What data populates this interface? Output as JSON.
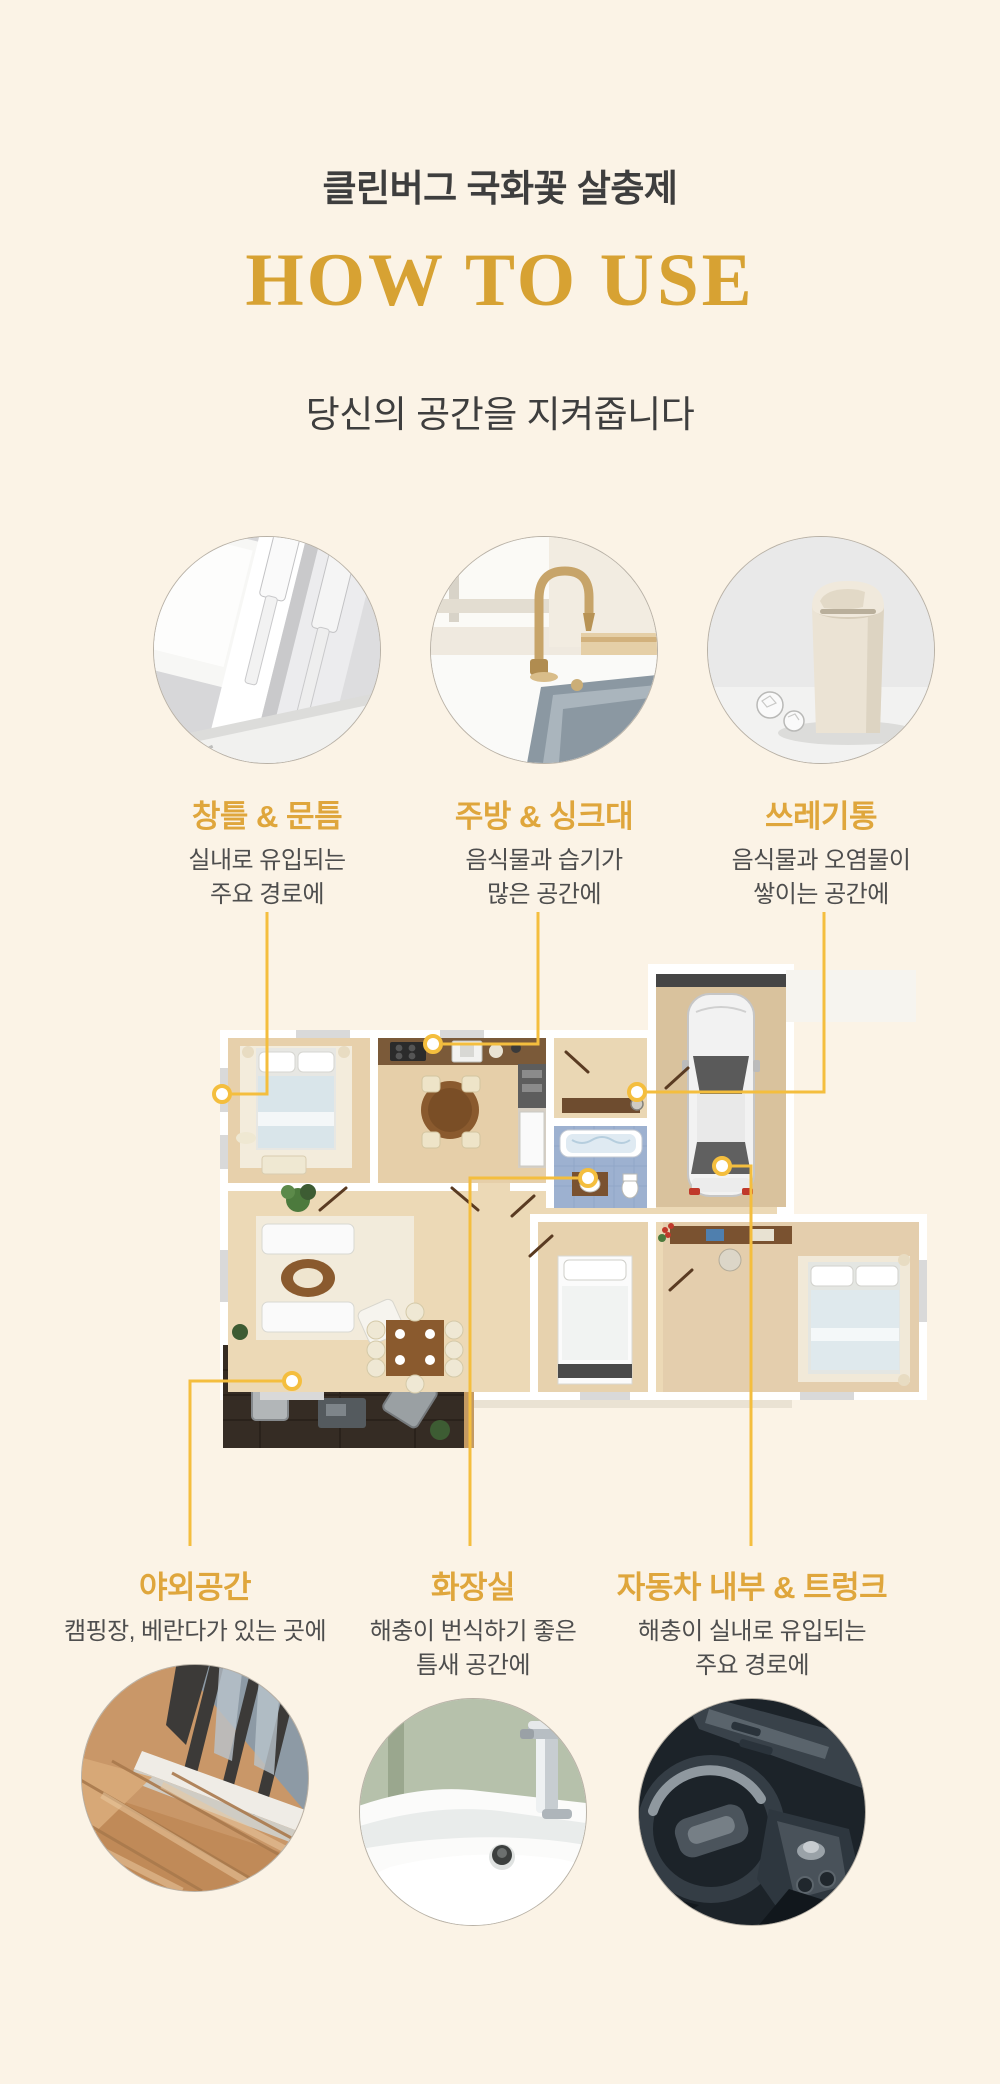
{
  "header": {
    "brand": "클린버그 국화꽃 살충제",
    "title": "HOW TO USE",
    "subtitle": "당신의 공간을 지켜줍니다"
  },
  "colors": {
    "background": "#FBF3E6",
    "accent_gold": "#DFA63C",
    "title_gold": "#D7A233",
    "connector_gold": "#F4BE3E",
    "text_dark": "#3E3E3E",
    "text_body": "#4E4E4E"
  },
  "top_features": [
    {
      "label": "창틀 & 문틈",
      "desc_line1": "실내로 유입되는",
      "desc_line2": "주요 경로에",
      "image": "window-frame-photo"
    },
    {
      "label": "주방 & 싱크대",
      "desc_line1": "음식물과 습기가",
      "desc_line2": "많은 공간에",
      "image": "kitchen-sink-photo"
    },
    {
      "label": "쓰레기통",
      "desc_line1": "음식물과 오염물이",
      "desc_line2": "쌓이는 공간에",
      "image": "trash-bin-photo"
    }
  ],
  "bottom_features": [
    {
      "label": "야외공간",
      "desc_line1": "캠핑장, 베란다가 있는 곳에",
      "desc_line2": "",
      "image": "balcony-photo"
    },
    {
      "label": "화장실",
      "desc_line1": "해충이 번식하기 좋은",
      "desc_line2": "틈새 공간에",
      "image": "bathroom-sink-photo"
    },
    {
      "label": "자동차 내부 & 트렁크",
      "desc_line1": "해충이 실내로 유입되는",
      "desc_line2": "주요 경로에",
      "image": "car-interior-photo"
    }
  ],
  "floor_plan": {
    "name": "apartment-floor-plan-top-view"
  }
}
